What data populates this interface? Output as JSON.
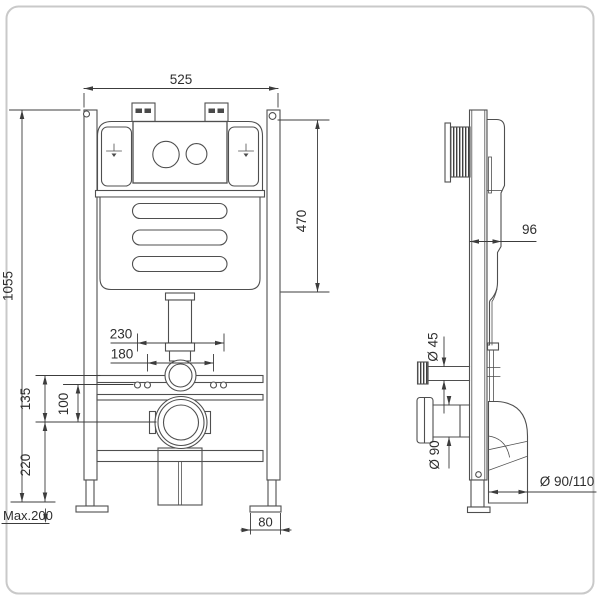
{
  "front_view": {
    "frame_width": "525",
    "frame_height": "1055",
    "bolt_spacing_outer": "230",
    "bolt_spacing_inner": "180",
    "rail_to_outlet": "135",
    "holes_to_outlet": "100",
    "outlet_to_floor": "220",
    "leg_adjustment": "Max.200",
    "foot_width": "80"
  },
  "side_view": {
    "top_to_outlet": "470",
    "frame_depth": "96",
    "flush_pipe_diameter": "Ø 45",
    "outlet_flange_diameter": "Ø 90",
    "waste_elbow_diameter": "Ø 90/110"
  }
}
